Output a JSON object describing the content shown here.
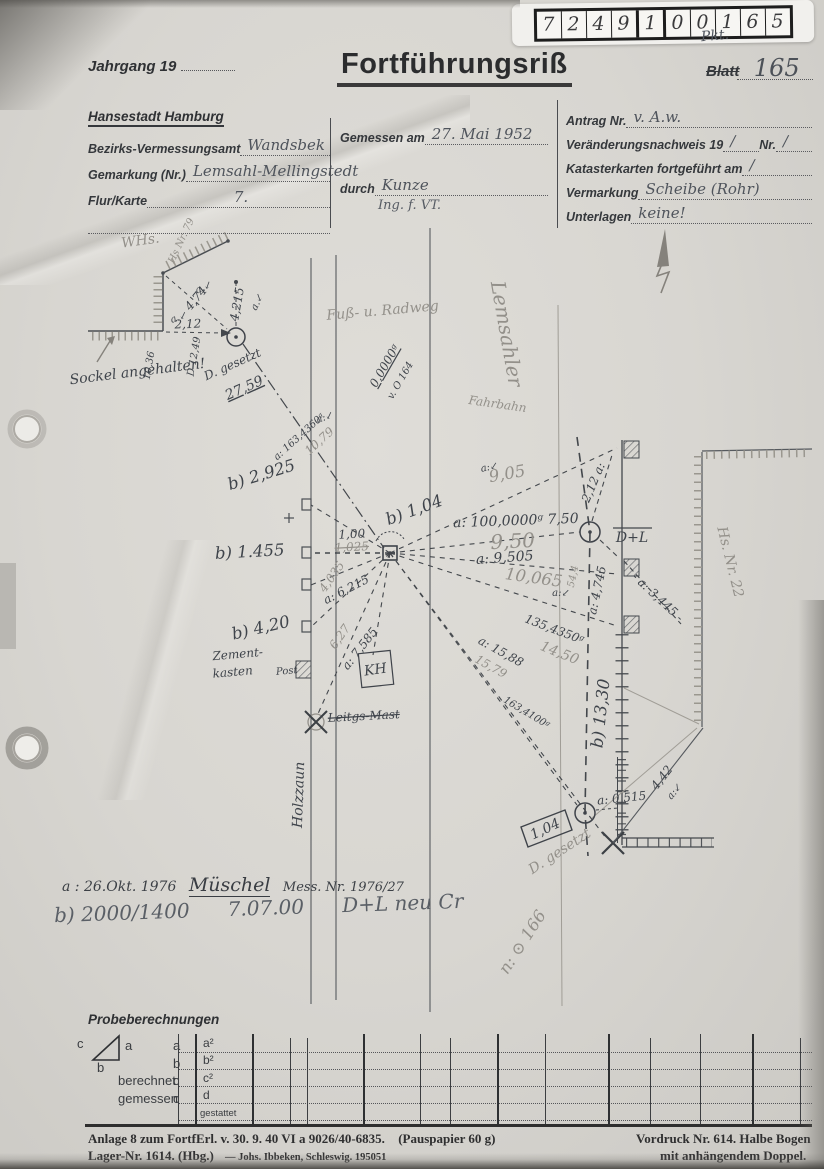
{
  "stamp": {
    "digits": [
      "7",
      "2",
      "4",
      "9",
      "1",
      "0",
      "0",
      "1",
      "6",
      "5"
    ]
  },
  "header": {
    "jahrgang_label": "Jahrgang 19",
    "title": "Fortführungsriß",
    "pkt": "Pkt.",
    "blatt_label": "Blatt",
    "blatt_value": "165"
  },
  "form": {
    "city": "Hansestadt Hamburg",
    "left": [
      {
        "label": "Bezirks-Vermessungsamt",
        "value": "Wandsbek"
      },
      {
        "label": "Gemarkung (Nr.)",
        "value": "Lemsahl-Mellingstedt"
      },
      {
        "label": "Flur/Karte",
        "value": "7."
      }
    ],
    "mid": [
      {
        "label": "Gemessen am",
        "value": "27. Mai 1952"
      },
      {
        "label": "durch",
        "value": "Kunze",
        "value2": "Ing. f. VT."
      }
    ],
    "right": [
      {
        "label": "Antrag Nr.",
        "value": "v. A.w."
      },
      {
        "label": "Veränderungsnachweis 19",
        "value": "∕",
        "label2": "Nr.",
        "value2": "∕"
      },
      {
        "label": "Katasterkarten fortgeführt am",
        "value": "∕"
      },
      {
        "label": "Vermarkung",
        "value": "Scheibe (Rohr)"
      },
      {
        "label": "Unterlagen",
        "value": "keine!"
      }
    ]
  },
  "sketch": {
    "labels": [
      {
        "t": "WHs.",
        "x": 141,
        "y": 245,
        "r": -8,
        "c": "pencil lg"
      },
      {
        "t": "Hs Nr. 79",
        "x": 184,
        "y": 242,
        "r": -65,
        "c": "pencil sm"
      },
      {
        "t": "Sockel angehalten!",
        "x": 138,
        "y": 376,
        "r": -7,
        "c": "ink lg"
      },
      {
        "t": "a.↙",
        "x": 205,
        "y": 290,
        "r": -25,
        "c": "ink sm"
      },
      {
        "t": "a.↙",
        "x": 180,
        "y": 320,
        "r": -20,
        "c": "ink sm"
      },
      {
        "t": "a.↙",
        "x": 260,
        "y": 303,
        "r": -65,
        "c": "ink sm"
      },
      {
        "t": "4,74",
        "x": 199,
        "y": 301,
        "r": -50,
        "c": "ink"
      },
      {
        "t": "2,12",
        "x": 188,
        "y": 328,
        "r": -2,
        "c": "ink"
      },
      {
        "t": "4,215",
        "x": 241,
        "y": 305,
        "r": -80,
        "c": "ink"
      },
      {
        "t": "10,36",
        "x": 152,
        "y": 366,
        "r": -80,
        "c": "ink sm"
      },
      {
        "t": "D 12,49",
        "x": 197,
        "y": 357,
        "r": -80,
        "c": "ink sm"
      },
      {
        "t": "D. gesetzt",
        "x": 234,
        "y": 368,
        "r": -24,
        "c": "ink"
      },
      {
        "t": "27,59",
        "x": 246,
        "y": 392,
        "r": -24,
        "c": "ink u lg"
      },
      {
        "t": "Fuß- u. Radweg",
        "x": 383,
        "y": 315,
        "r": -5,
        "c": "pencil lg"
      },
      {
        "t": "0,0000ᵍ",
        "x": 388,
        "y": 368,
        "r": -60,
        "c": "ink u"
      },
      {
        "t": "v. O 164",
        "x": 403,
        "y": 382,
        "r": -60,
        "c": "ink sm"
      },
      {
        "t": "Lemsahler",
        "x": 500,
        "y": 335,
        "r": 80,
        "c": "pencil xxl"
      },
      {
        "t": "Fahrbahn",
        "x": 497,
        "y": 408,
        "r": 8,
        "c": "pencil"
      },
      {
        "t": "a:↙",
        "x": 326,
        "y": 420,
        "r": -20,
        "c": "ink sm"
      },
      {
        "t": "a: 163,4360ᵍ",
        "x": 301,
        "y": 439,
        "r": -42,
        "c": "ink sm"
      },
      {
        "t": "10,79",
        "x": 322,
        "y": 444,
        "r": -42,
        "c": "pencil"
      },
      {
        "t": "b) 2,925",
        "x": 263,
        "y": 480,
        "r": -17,
        "c": "ink xl"
      },
      {
        "t": "b) 1.455",
        "x": 250,
        "y": 557,
        "r": -3,
        "c": "ink xl"
      },
      {
        "t": "b) 1,04",
        "x": 416,
        "y": 515,
        "r": -20,
        "c": "ink xl"
      },
      {
        "t": "1,00",
        "x": 352,
        "y": 538,
        "r": -3,
        "c": "ink"
      },
      {
        "t": "1,025",
        "x": 352,
        "y": 551,
        "r": -3,
        "c": "pencil strike"
      },
      {
        "t": "a: 6,215",
        "x": 348,
        "y": 593,
        "r": -27,
        "c": "ink"
      },
      {
        "t": "4,035",
        "x": 335,
        "y": 579,
        "r": -55,
        "c": "pencil"
      },
      {
        "t": "b) 4,20",
        "x": 262,
        "y": 633,
        "r": -13,
        "c": "ink xl"
      },
      {
        "t": "Zement-",
        "x": 238,
        "y": 658,
        "r": -5,
        "c": "ink"
      },
      {
        "t": "kasten",
        "x": 233,
        "y": 676,
        "r": -5,
        "c": "ink"
      },
      {
        "t": "Post",
        "x": 287,
        "y": 674,
        "r": -5,
        "c": "ink sm"
      },
      {
        "t": "6,27",
        "x": 343,
        "y": 639,
        "r": -55,
        "c": "pencil"
      },
      {
        "t": "a: 7,585",
        "x": 363,
        "y": 651,
        "r": -52,
        "c": "ink"
      },
      {
        "t": "KH",
        "x": 376,
        "y": 674,
        "r": -8,
        "c": "ink lg"
      },
      {
        "t": "Leitgs-Mast",
        "x": 364,
        "y": 720,
        "r": -3,
        "c": "ink strike"
      },
      {
        "t": "Holzzaun",
        "x": 303,
        "y": 795,
        "r": -88,
        "c": "ink lg"
      },
      {
        "t": "a:↙",
        "x": 490,
        "y": 470,
        "r": -12,
        "c": "ink sm"
      },
      {
        "t": "9,05",
        "x": 508,
        "y": 479,
        "r": -10,
        "c": "pencil xl"
      },
      {
        "t": "a: 100,0000ᵍ  7,50",
        "x": 516,
        "y": 525,
        "r": -2,
        "c": "ink lg"
      },
      {
        "t": "9,50",
        "x": 513,
        "y": 548,
        "r": -3,
        "c": "pencil xxl"
      },
      {
        "t": "a: 9,505",
        "x": 505,
        "y": 562,
        "r": -4,
        "c": "ink lg"
      },
      {
        "t": "10,065",
        "x": 533,
        "y": 583,
        "r": 8,
        "c": "pencil xl"
      },
      {
        "t": "a:↙",
        "x": 561,
        "y": 596,
        "r": 0,
        "c": "ink sm"
      },
      {
        "t": "2,12 a:",
        "x": 597,
        "y": 484,
        "r": -67,
        "c": "ink"
      },
      {
        "t": "D+L",
        "x": 632,
        "y": 542,
        "r": 0,
        "c": "ink lg"
      },
      {
        "t": "54,4",
        "x": 576,
        "y": 577,
        "r": -78,
        "c": "pencil sm"
      },
      {
        "t": "a: 4,745",
        "x": 601,
        "y": 591,
        "r": -78,
        "c": "ink"
      },
      {
        "t": "- a: 3,445 -",
        "x": 655,
        "y": 600,
        "r": 43,
        "c": "ink"
      },
      {
        "t": "135,4350ᵍ",
        "x": 553,
        "y": 633,
        "r": 21,
        "c": "ink"
      },
      {
        "t": "14,50",
        "x": 558,
        "y": 657,
        "r": 22,
        "c": "pencil lg"
      },
      {
        "t": "a: 15,88",
        "x": 499,
        "y": 655,
        "r": 29,
        "c": "ink"
      },
      {
        "t": "15,79",
        "x": 489,
        "y": 670,
        "r": 29,
        "c": "pencil"
      },
      {
        "t": "163,4100ᵍ",
        "x": 525,
        "y": 715,
        "r": 31,
        "c": "ink sm"
      },
      {
        "t": "b) 13,30",
        "x": 606,
        "y": 714,
        "r": -84,
        "c": "ink xl"
      },
      {
        "t": "a: 0,515",
        "x": 622,
        "y": 802,
        "r": -6,
        "c": "ink"
      },
      {
        "t": "1,04",
        "x": 547,
        "y": 833,
        "r": -25,
        "c": "ink lg"
      },
      {
        "t": "D. gesetzt",
        "x": 562,
        "y": 855,
        "r": -33,
        "c": "pencil lg"
      },
      {
        "t": "4,42",
        "x": 665,
        "y": 780,
        "r": -52,
        "c": "ink"
      },
      {
        "t": "a:↙",
        "x": 677,
        "y": 793,
        "r": -52,
        "c": "ink sm"
      },
      {
        "t": "n: ⊙ 166",
        "x": 527,
        "y": 945,
        "r": -57,
        "c": "pencil xl"
      },
      {
        "t": "Hs. Nr. 22",
        "x": 726,
        "y": 563,
        "r": 76,
        "c": "pencil lg"
      }
    ]
  },
  "notes": {
    "a_prefix": "a : 26.Okt. 1976",
    "a_name": "Müschel",
    "a_suffix": "Mess. Nr. 1976/27",
    "b_line": "b) 2000/1400      7.07.00      D+L neu Cr"
  },
  "probe": {
    "title": "Probeberechnungen",
    "tri": {
      "a": "a",
      "b": "b",
      "c": "c"
    },
    "rows": [
      {
        "label": "",
        "letter": "a"
      },
      {
        "label": "",
        "letter": "b"
      },
      {
        "label": "berechnet",
        "letter": "c"
      },
      {
        "label": "gemessen",
        "letter": "c"
      }
    ],
    "cols": [
      "a²",
      "b²",
      "c²",
      "d"
    ],
    "gestattet": "gestattet"
  },
  "footer": {
    "left1": "Anlage 8 zum FortfErl. v. 30. 9. 40 VI a 9026/40-6835.",
    "left1b": "(Pauspapier 60 g)",
    "left2": "Lager-Nr. 1614. (Hbg.)",
    "left2b": "—  Johs. Ibbeken, Schleswig. 195051",
    "right1": "Vordruck Nr. 614.  Halbe Bogen",
    "right2": "mit anhängendem Doppel."
  }
}
